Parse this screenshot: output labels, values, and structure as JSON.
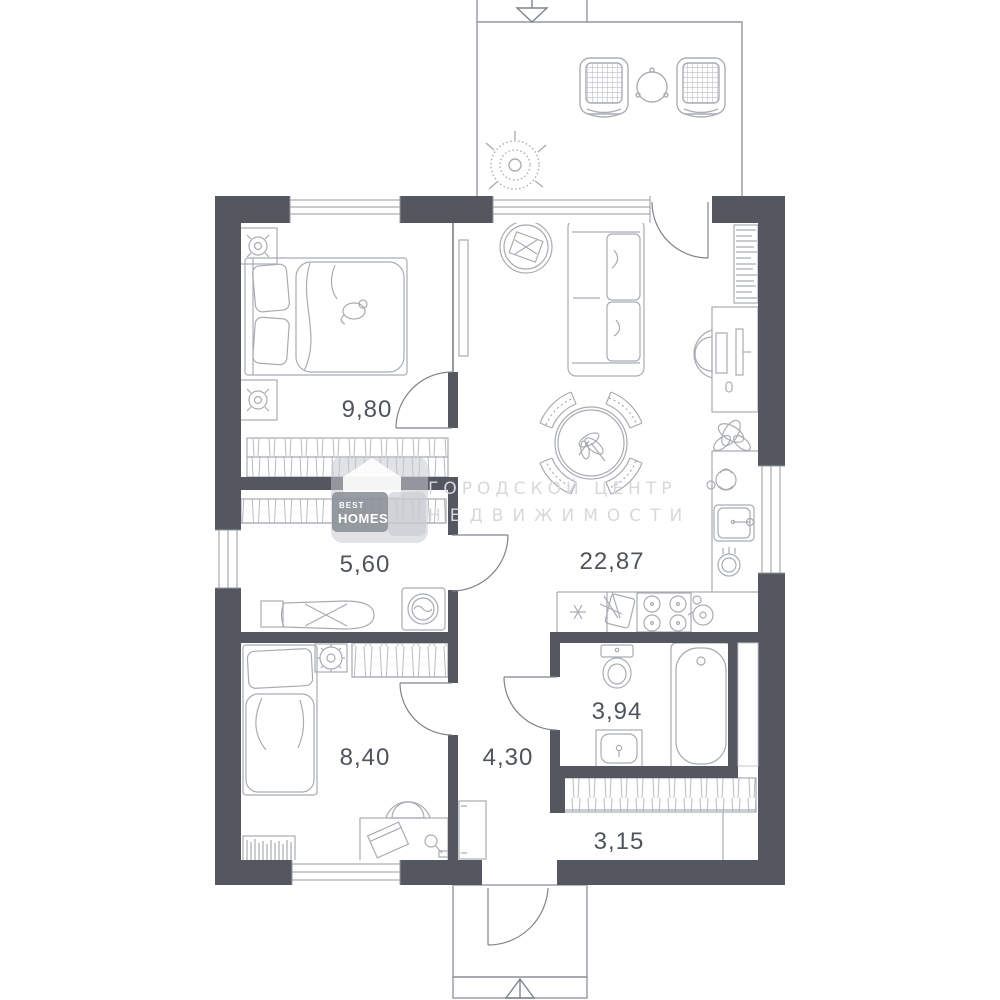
{
  "plan": {
    "rooms": [
      {
        "id": "bedroom-1",
        "area": "9,80"
      },
      {
        "id": "dressing-room",
        "area": "5,60"
      },
      {
        "id": "living-kitchen",
        "area": "22,87"
      },
      {
        "id": "bedroom-2",
        "area": "8,40"
      },
      {
        "id": "hallway",
        "area": "4,30"
      },
      {
        "id": "bathroom",
        "area": "3,94"
      },
      {
        "id": "entry",
        "area": "3,15"
      }
    ]
  },
  "watermark": {
    "brand_top": "BEST",
    "brand_bottom": "HOMES",
    "line1": "ГОРОДСКОЙ ЦЕНТР",
    "line2": "НЕДВИЖИМОСТИ"
  },
  "colors": {
    "wall": "#54575f",
    "furniture_line": "#a8acb2",
    "structure_line": "#94989f",
    "door_line": "#7f848b",
    "label": "#4f545c",
    "watermark_text": "#d6d8db"
  }
}
